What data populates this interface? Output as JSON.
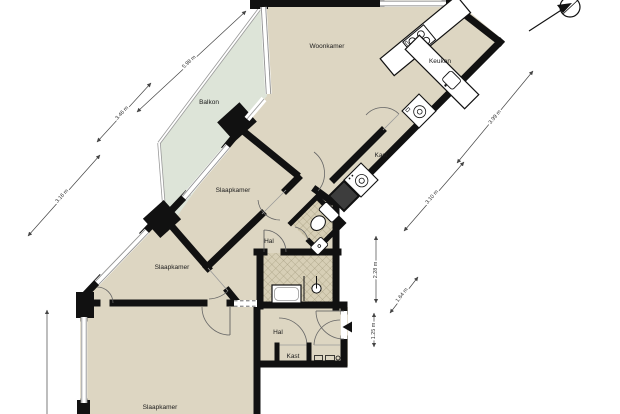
{
  "title": "Floor plan (plattegrond)",
  "rooms": {
    "woonkamer": "Woonkamer",
    "keuken": "Keuken",
    "balkon": "Balkon",
    "slaapkamer_mid": "Slaapkamer",
    "slaapkamer_left": "Slaapkamer",
    "slaapkamer_bottom": "Slaapkamer",
    "kast_upper": "Kast",
    "kast_lower": "Kast",
    "hal_upper": "Hal",
    "hal_lower": "Hal"
  },
  "dimensions": {
    "balcony_length": "5.98 m",
    "balcony_width": "3.46 m",
    "left_facade": "3.16 m",
    "kitchen_facade": "3.99 m",
    "corridor_side": "3.10 m",
    "bathroom_depth": "2.28 m",
    "wc_width": "1.64 m",
    "entrance_depth": "1.25 m"
  },
  "markers": {
    "entrance": "entrance-arrow",
    "compass": "north-compass"
  },
  "colors": {
    "floor": "#ddd6c2",
    "balcony_floor": "#dde4d8",
    "wall": "#111111",
    "tile_base": "#d7cfb6",
    "tile_line": "#a79f82",
    "dimension_line": "#555555"
  }
}
